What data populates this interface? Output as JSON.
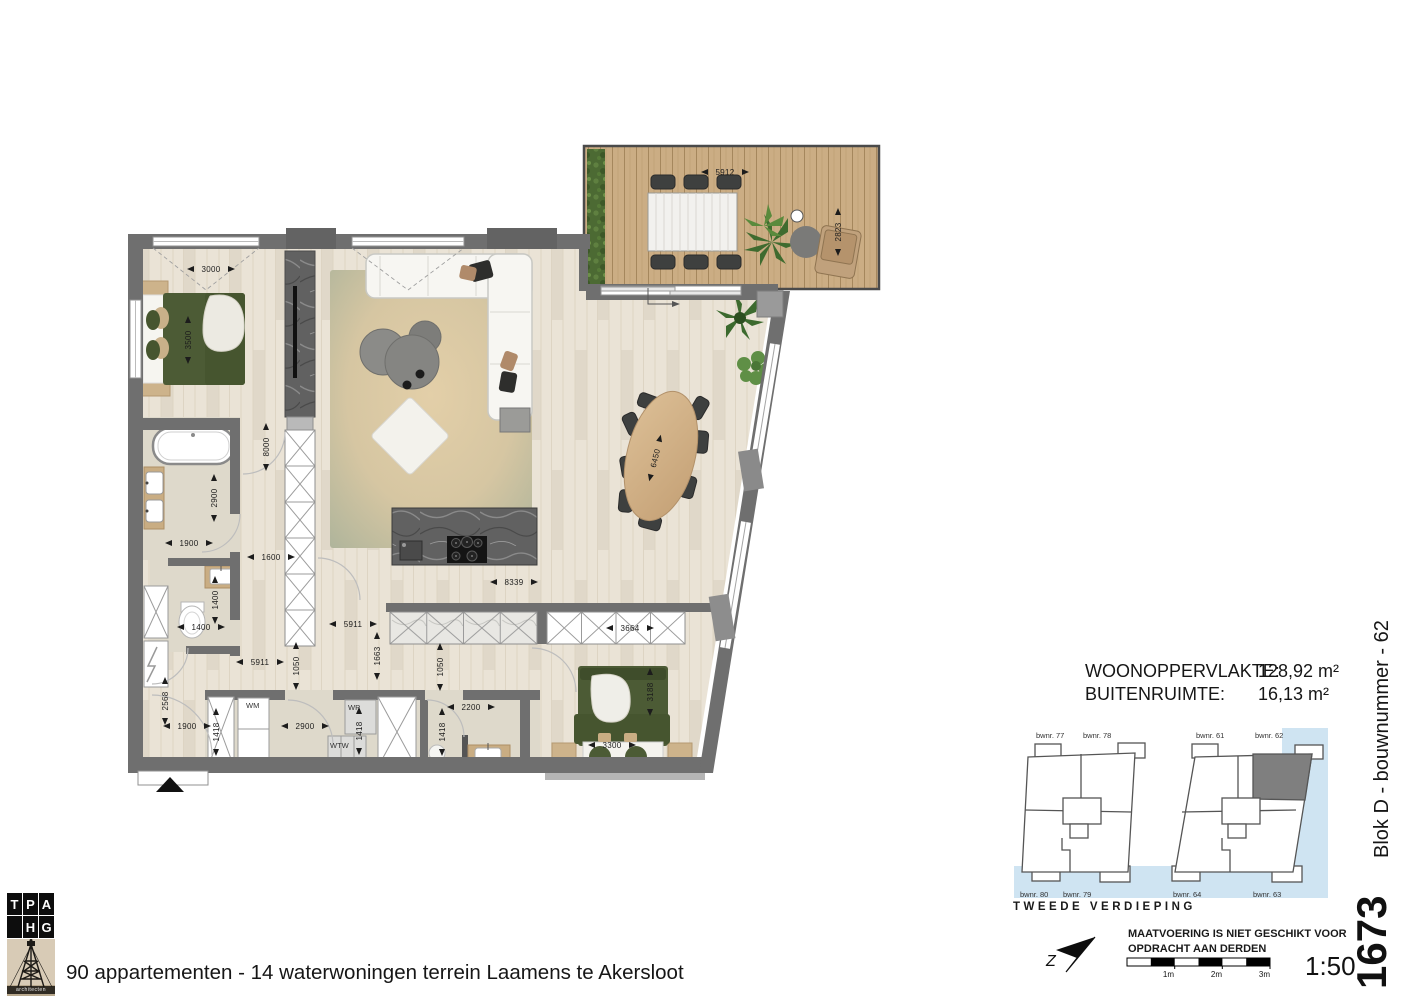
{
  "areas": {
    "rows": [
      {
        "label": "WOONOPPERVLAKTE:",
        "value": "128,92 m²"
      },
      {
        "label": "BUITENRUIMTE:",
        "value": "16,13 m²"
      }
    ]
  },
  "overview": {
    "labels": [
      "bwnr. 77",
      "bwnr. 78",
      "bwnr. 80",
      "bwnr. 79",
      "bwnr. 61",
      "bwnr. 62",
      "bwnr. 64",
      "bwnr. 63"
    ],
    "floor_label": "TWEEDE VERDIEPING",
    "highlighted_unit": "bwnr. 62"
  },
  "north": {
    "letter": "Z"
  },
  "disclaimer": {
    "line1": "MAATVOERING IS NIET GESCHIKT VOOR",
    "line2": "OPDRACHT AAN DERDEN"
  },
  "scalebar": {
    "labels": [
      "1m",
      "2m",
      "3m"
    ],
    "ratio": "1:50"
  },
  "titleblock": {
    "sheet_number": "1673",
    "unit_label": "Blok D - bouwnummer - 62",
    "project_caption": "90 appartementen - 14 waterwoningen terrein Laamens te Akersloot"
  },
  "logo": {
    "row1": [
      "T",
      "P",
      "A"
    ],
    "row2": [
      "H",
      "G"
    ],
    "subtitle": "architecten"
  },
  "plan": {
    "appliances": {
      "wm": "WM",
      "wp": "WP",
      "wtw": "WTW"
    },
    "dims": {
      "terrace_width": "5912",
      "terrace_depth": "2823",
      "bed1_width": "3000",
      "bed1_depth": "3500",
      "hall_height": "8000",
      "bath_depth": "2900",
      "bath_width": "1900",
      "closet_width": "1600",
      "wc_depth": "1400",
      "wc_width": "1400",
      "kitchen_width": "8339",
      "hall_width_a": "5911",
      "hall_width_b": "5911",
      "pass_a": "1050",
      "pass_b": "1663",
      "pass_c": "1050",
      "cabinet_width": "3664",
      "table_length": "6450",
      "entry_width": "1900",
      "entry_depth": "2568",
      "utility_width": "2900",
      "utility_depth": "1418",
      "closet_depth": "1418",
      "bath2_width": "2200",
      "bath2_depth": "1418",
      "bed2_depth": "3188",
      "bed2_width": "3300"
    }
  },
  "colors": {
    "wall": "#6f6f6f",
    "wood_floor": "#eae3d6",
    "stone_floor": "#ded9cb",
    "deck": "#cbad84",
    "water": "#cfe4f2",
    "bed_green": "#4c5b35",
    "highlight_unit": "#7f7f7f"
  }
}
